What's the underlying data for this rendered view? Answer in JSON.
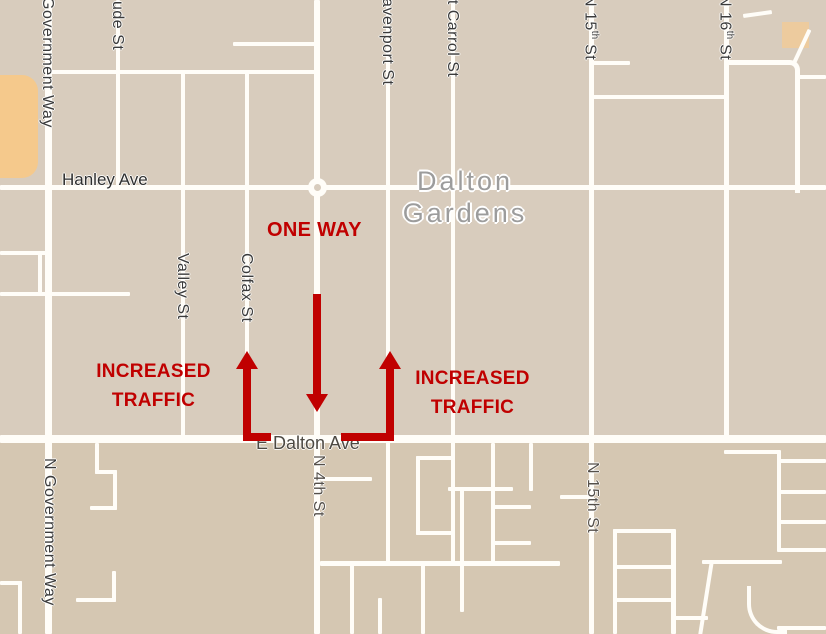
{
  "map": {
    "place_name": {
      "line1": "Dalton",
      "line2": "Gardens"
    },
    "streets": {
      "government_way_top": "Government Way",
      "government_way_bottom": "N Government Way",
      "ude": "ude St",
      "valley": "Valley St",
      "colfax": "Colfax St",
      "n4th": "N 4th St",
      "davenport": "Davenport St",
      "mt_carrol": "Mt Carrol St",
      "n15th": {
        "pre": "N 15",
        "sup": "th",
        "post": " St",
        "full": "N 15th St"
      },
      "n16th": {
        "pre": "N 16",
        "sup": "th",
        "post": " St"
      },
      "hanley": "Hanley Ave",
      "e_dalton": "E Dalton Ave"
    }
  },
  "annotations": {
    "one_way": "ONE WAY",
    "increased_traffic_left": {
      "line1": "INCREASED",
      "line2": "TRAFFIC"
    },
    "increased_traffic_right": {
      "line1": "INCREASED",
      "line2": "TRAFFIC"
    },
    "arrows": [
      {
        "name": "one-way-south-arrow",
        "street": "N 4th St",
        "direction": "south"
      },
      {
        "name": "increased-traffic-arrow-west",
        "street": "Colfax St",
        "direction": "north"
      },
      {
        "name": "increased-traffic-arrow-east",
        "street": "Davenport St",
        "direction": "north"
      }
    ],
    "color": "#c00000"
  },
  "colors": {
    "map_background_north": "#d8ccbd",
    "map_background_south": "#d5c7b2",
    "road": "#ffffff",
    "street_label": "#3b3b3b",
    "place_label": "#9c9c9c",
    "annotation_red": "#c00000",
    "landuse_orange": "#f5c98c"
  }
}
